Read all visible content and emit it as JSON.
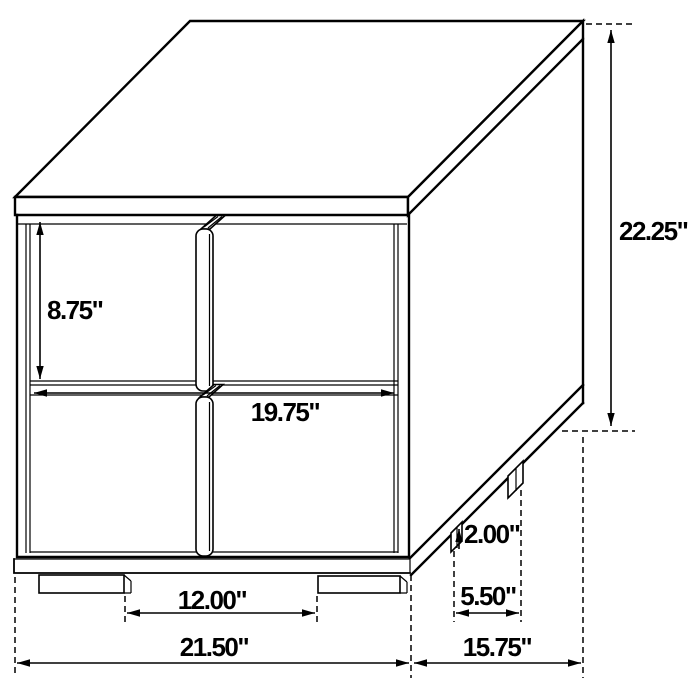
{
  "colors": {
    "line": "#000000",
    "background": "#ffffff",
    "text": "#000000"
  },
  "dimensions": {
    "drawer_height": "8.75\"",
    "drawer_width": "19.75\"",
    "overall_height": "22.25\"",
    "leg_height": "2.00\"",
    "side_leg_spacing": "5.50\"",
    "front_leg_spacing": "12.00\"",
    "overall_width": "21.50\"",
    "overall_depth": "15.75\""
  }
}
